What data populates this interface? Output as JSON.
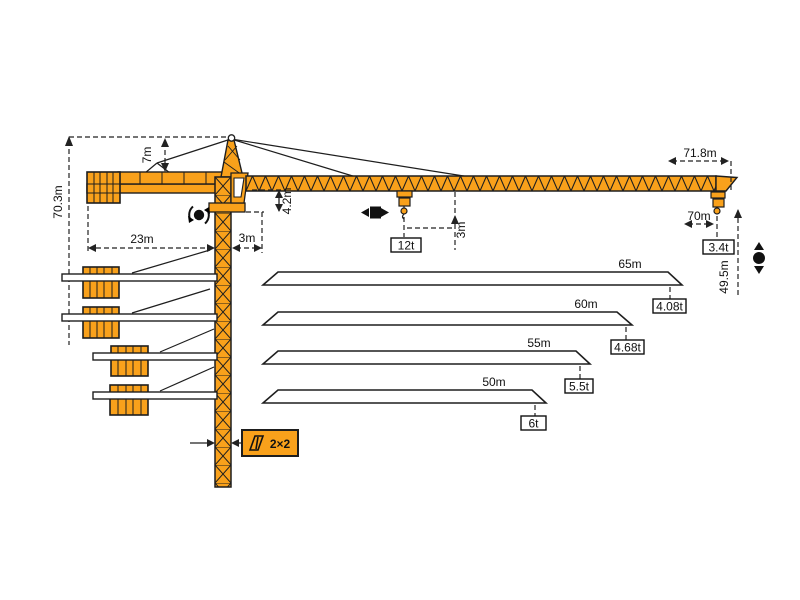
{
  "colors": {
    "crane_orange": "#F9A11B",
    "outline": "#1e1e1e",
    "dim_line": "#222222",
    "white": "#ffffff"
  },
  "labels": {
    "total_height": "70.3m",
    "top_tower_height": "7m",
    "counterjib_radius": "23m",
    "slew_offset": "3m",
    "jib_depth": "4.2m",
    "trolley_height_offset": "3m",
    "max_capacity": "12t",
    "jib_overall_length": "71.8m",
    "max_working_radius": "70m",
    "tip_capacity": "3.4t",
    "hook_height": "49.5m",
    "mast_section": "2×2"
  },
  "jib_variants": [
    {
      "length": "65m",
      "tip_load": "4.08t"
    },
    {
      "length": "60m",
      "tip_load": "4.68t"
    },
    {
      "length": "55m",
      "tip_load": "5.5t"
    },
    {
      "length": "50m",
      "tip_load": "6t"
    }
  ],
  "icons": {
    "slewing": "rotation-circle-arrows",
    "trolley_travel": "left-right-arrows-square",
    "hoisting": "up-down-arrows-circle",
    "mast_section": "lattice-section-glyph"
  }
}
